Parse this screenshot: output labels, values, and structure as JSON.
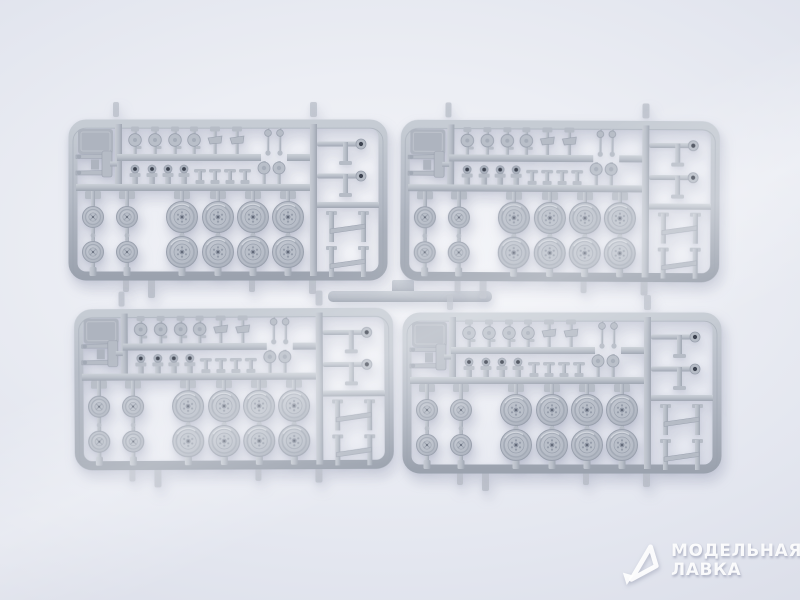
{
  "scene": {
    "type": "product-photo",
    "subject": "Four identical light-gray injection-molded plastic model kit sprues with road wheels, small wheels, suspension parts and brackets, arranged in a 2x2 grid on a bright white background",
    "sprues": [
      {
        "id": "sprue-top-left",
        "label": "plastic sprue, top left"
      },
      {
        "id": "sprue-top-right",
        "label": "plastic sprue, top right"
      },
      {
        "id": "sprue-bottom-left",
        "label": "plastic sprue, bottom left"
      },
      {
        "id": "sprue-bottom-right",
        "label": "plastic sprue, bottom right"
      }
    ],
    "per_sprue_contents": {
      "large_road_wheels": 8,
      "small_wheels": 4,
      "top_row_small_parts": 8,
      "middle_row_small_parts": 10,
      "right_column_brackets": 4,
      "axle_part": 1
    },
    "colors": {
      "background_center": "#f3f4f8",
      "background_edge": "#d4d8e4",
      "plastic_base": "#b6bcc6",
      "plastic_shadow": "#99a0ad",
      "plastic_highlight": "#d8dce3",
      "part_hole_dark": "#3d4350",
      "watermark_text": "#ffffff"
    }
  },
  "watermark": {
    "line1": "МОДЕЛЬНАЯ",
    "line2": "ЛАВКА",
    "logo": "modelnaya-lavka-triangle-arrow-logo"
  }
}
